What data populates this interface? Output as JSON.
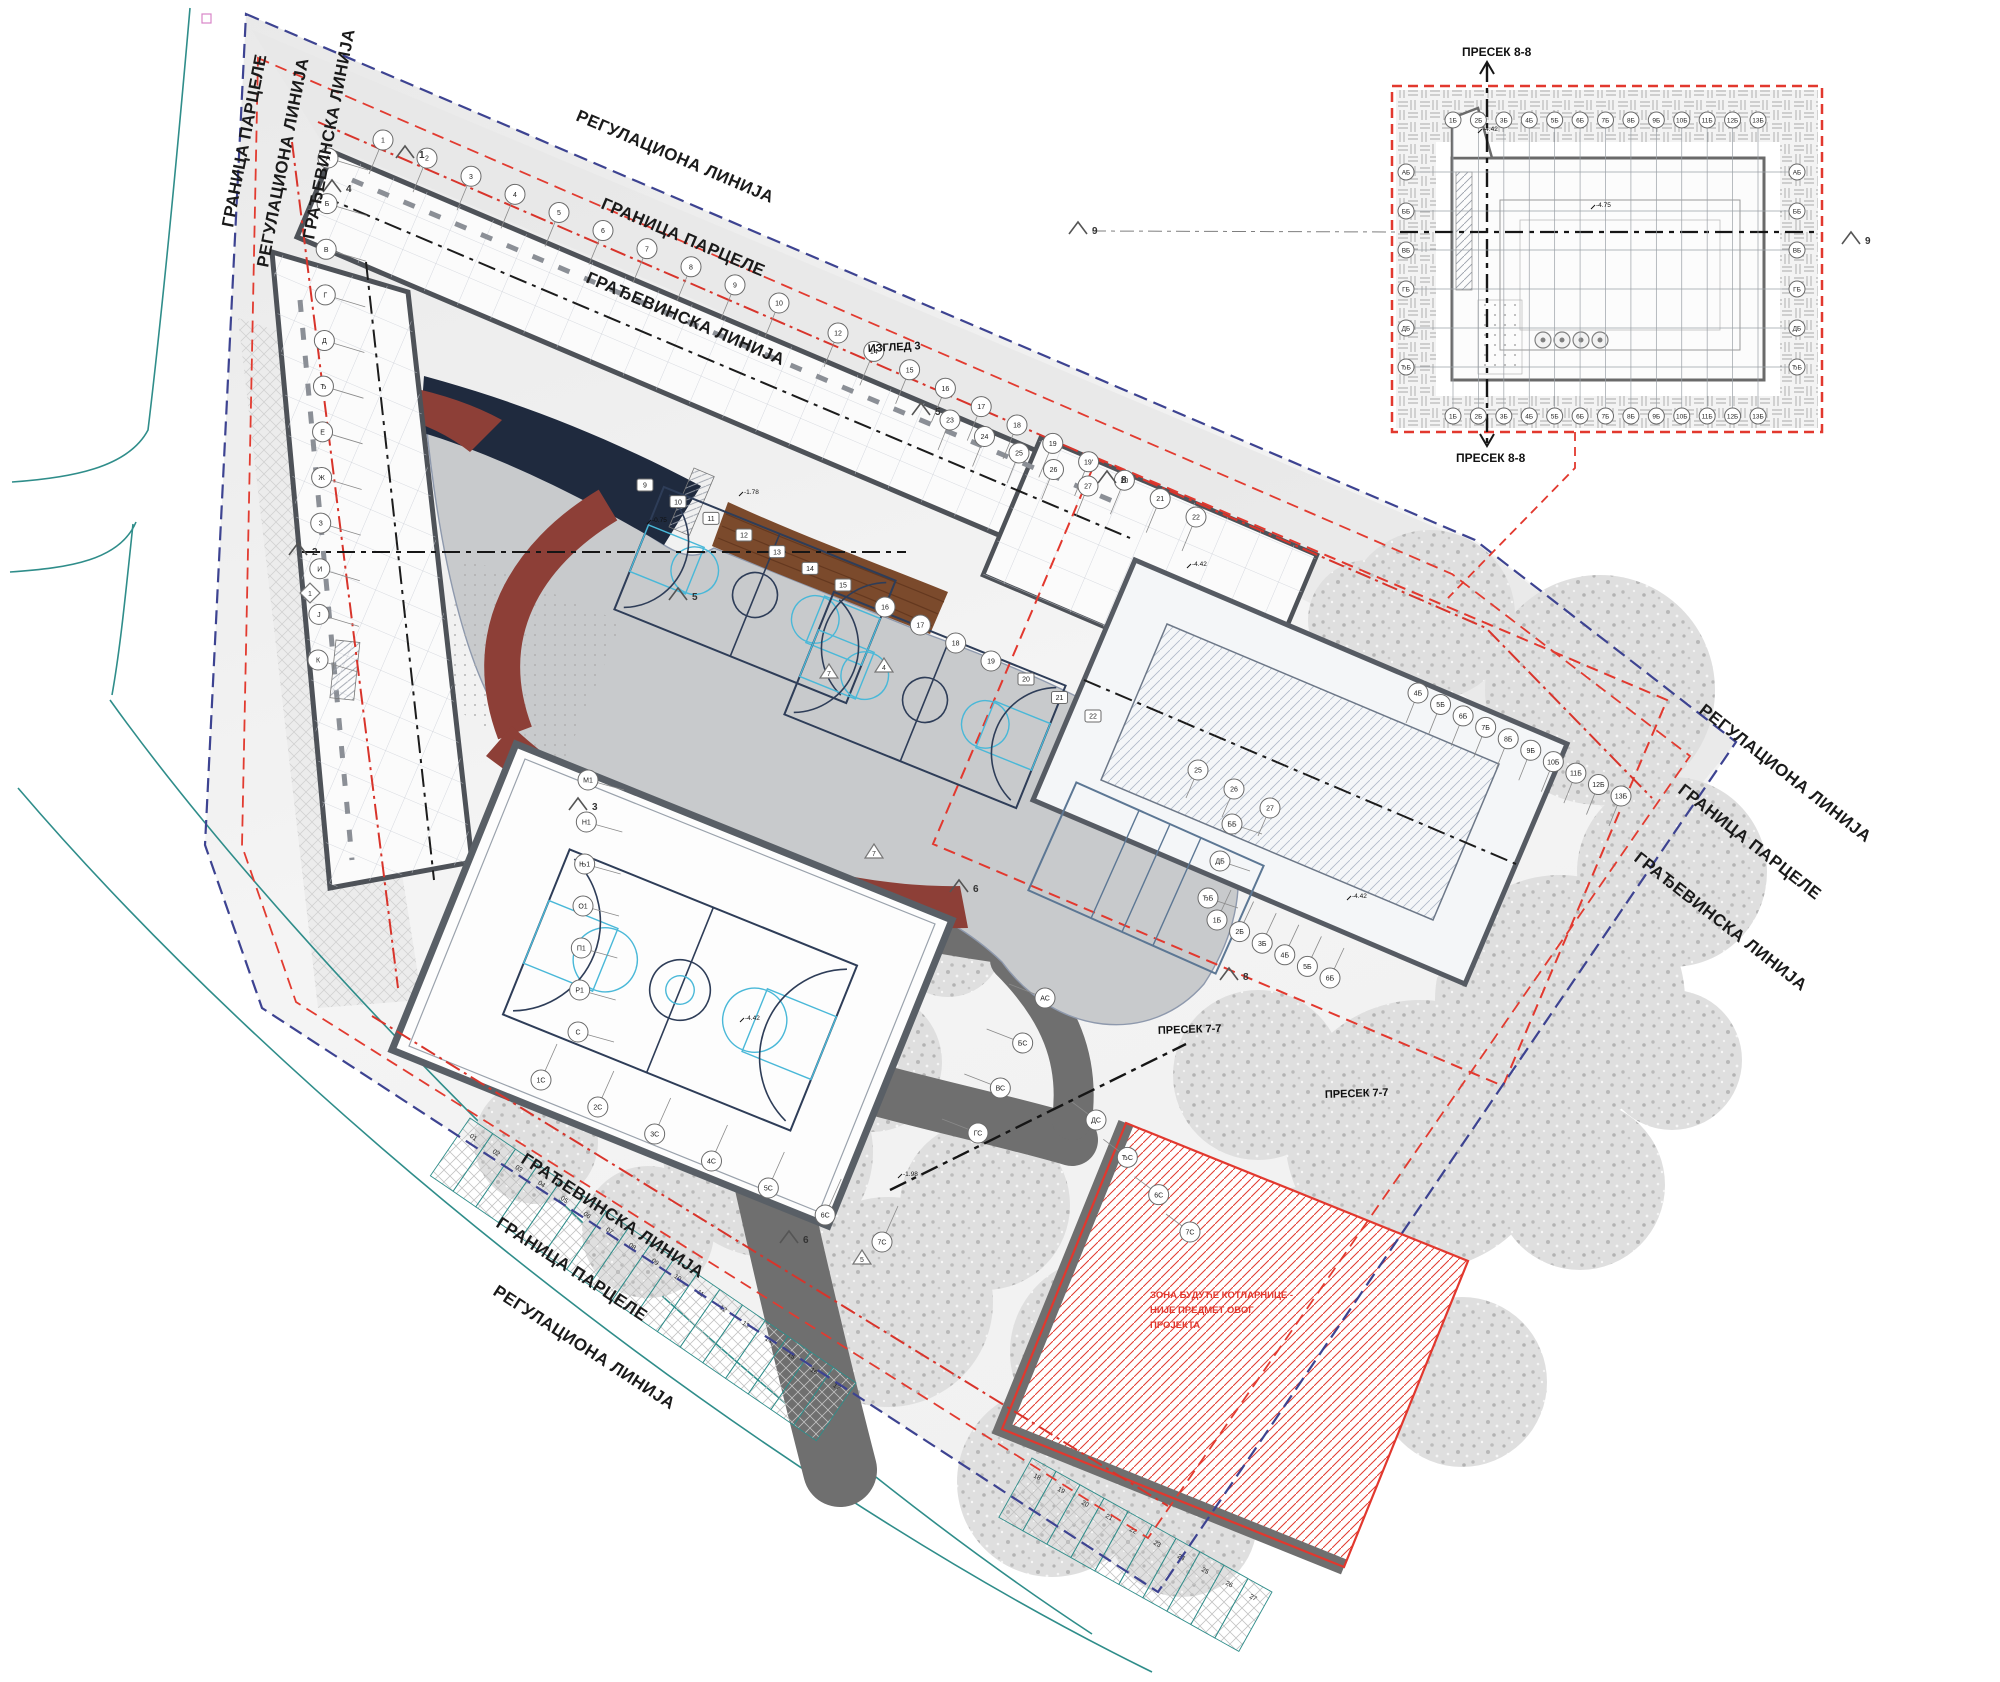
{
  "drawing": {
    "type": "architectural-site-plan",
    "colors": {
      "regulation_line": "#3d4391",
      "parcel_line": "#e23b30",
      "building_line": "#d8342b",
      "street_curb": "#2f8d8a",
      "plaza": "#c8cacc",
      "canopy_navy": "#1f2a3e",
      "canopy_maroon": "#8d3f37",
      "deck_brown": "#7b4a2c",
      "road_gray": "#6f6f6f",
      "tree_gray": "#bcbcbc",
      "court_line": "#2e3d58",
      "court_accent": "#49b8d8",
      "zone_red": "#e2382e"
    },
    "boundary_labels": [
      {
        "text": "РЕГУЛАЦИОНА ЛИНИЈА",
        "x": 575,
        "y": 120,
        "rot": 23
      },
      {
        "text": "ГРАНИЦА ПАРЦЕЛЕ",
        "x": 600,
        "y": 208,
        "rot": 23
      },
      {
        "text": "ГРАЂЕВИНСКА ЛИНИЈА",
        "x": 585,
        "y": 282,
        "rot": 23
      },
      {
        "text": "ГРАНИЦА ПАРЦЕЛЕ",
        "x": 233,
        "y": 228,
        "rot": -79
      },
      {
        "text": "РЕГУЛАЦИОНА ЛИНИЈА",
        "x": 268,
        "y": 268,
        "rot": -79
      },
      {
        "text": "ГРАЂЕВИНСКА ЛИНИЈА",
        "x": 314,
        "y": 240,
        "rot": -79
      },
      {
        "text": "РЕГУЛАЦИОНА ЛИНИЈА",
        "x": 1698,
        "y": 712,
        "rot": 38
      },
      {
        "text": "ГРАНИЦА ПАРЦЕЛЕ",
        "x": 1677,
        "y": 792,
        "rot": 38
      },
      {
        "text": "ГРАЂЕВИНСКА ЛИНИЈА",
        "x": 1633,
        "y": 860,
        "rot": 38
      },
      {
        "text": "ГРАЂЕВИНСКА ЛИНИЈА",
        "x": 520,
        "y": 1162,
        "rot": 33
      },
      {
        "text": "ГРАНИЦА ПАРЦЕЛЕ",
        "x": 495,
        "y": 1226,
        "rot": 33
      },
      {
        "text": "РЕГУЛАЦИОНА ЛИНИЈА",
        "x": 492,
        "y": 1294,
        "rot": 33
      }
    ],
    "section_labels": [
      {
        "text": "ПРЕСЕК 7-7",
        "x": 1158,
        "y": 1034,
        "rot": -2
      },
      {
        "text": "ПРЕСЕК 7-7",
        "x": 1325,
        "y": 1098,
        "rot": -2
      },
      {
        "text": "ИЗГЛЕД 3",
        "x": 868,
        "y": 352,
        "rot": -3
      }
    ],
    "inset": {
      "title_top": "ПРЕСЕК 8-8",
      "title_bottom": "ПРЕСЕК 8-8",
      "section_marker": "9"
    },
    "zone_note": {
      "lines": [
        "ЗОНА БУДУЋЕ КОТЛАРНИЦЕ -",
        "НИЈЕ ПРЕДМЕТ ОВОГ",
        "ПРОЈЕКТА"
      ],
      "x": 1150,
      "y": 1298,
      "color": "#e2382e"
    },
    "section_markers": [
      {
        "label": "1",
        "x": 405,
        "y": 152,
        "shape": "chevron"
      },
      {
        "label": "4",
        "x": 332,
        "y": 186,
        "shape": "chevron"
      },
      {
        "label": "2",
        "x": 298,
        "y": 549,
        "shape": "chevron"
      },
      {
        "label": "1",
        "x": 310,
        "y": 593,
        "shape": "diamond"
      },
      {
        "label": "3",
        "x": 578,
        "y": 804,
        "shape": "chevron"
      },
      {
        "label": "5",
        "x": 678,
        "y": 594,
        "shape": "chevron"
      },
      {
        "label": "5",
        "x": 921,
        "y": 409,
        "shape": "chevron"
      },
      {
        "label": "4",
        "x": 884,
        "y": 666,
        "shape": "triangle"
      },
      {
        "label": "7",
        "x": 829,
        "y": 672,
        "shape": "triangle"
      },
      {
        "label": "7",
        "x": 874,
        "y": 852,
        "shape": "triangle"
      },
      {
        "label": "6",
        "x": 789,
        "y": 1237,
        "shape": "chevron"
      },
      {
        "label": "5",
        "x": 862,
        "y": 1258,
        "shape": "triangle"
      },
      {
        "label": "6",
        "x": 959,
        "y": 886,
        "shape": "chevron"
      },
      {
        "label": "8",
        "x": 1107,
        "y": 477,
        "shape": "chevron"
      },
      {
        "label": "8",
        "x": 1229,
        "y": 974,
        "shape": "chevron"
      },
      {
        "label": "9",
        "x": 1078,
        "y": 228,
        "shape": "chevron"
      },
      {
        "label": "9",
        "x": 1851,
        "y": 238,
        "shape": "chevron"
      }
    ],
    "grid_runs": [
      {
        "labels": [
          "1",
          "2",
          "3",
          "4",
          "5",
          "6",
          "7",
          "8",
          "9",
          "10"
        ],
        "x1": 383,
        "y1": 140,
        "x2": 779,
        "y2": 303,
        "stub": [
          -14,
          34
        ]
      },
      {
        "labels": [
          "12",
          "14",
          "15",
          "16",
          "17",
          "18",
          "19",
          "19'",
          "20",
          "21",
          "22"
        ],
        "x1": 838,
        "y1": 333,
        "x2": 1196,
        "y2": 517,
        "stub": [
          -14,
          34
        ]
      },
      {
        "labels": [
          "23",
          "24",
          "25",
          "26",
          "27"
        ],
        "x1": 950,
        "y1": 420,
        "x2": 1088,
        "y2": 486,
        "stub": [
          -12,
          30
        ]
      },
      {
        "labels": [
          "25",
          "26",
          "27"
        ],
        "x1": 1198,
        "y1": 770,
        "x2": 1270,
        "y2": 808,
        "stub": [
          -12,
          28
        ]
      },
      {
        "labels": [
          "А",
          "Б",
          "В",
          "Г",
          "Д",
          "Ђ",
          "Е",
          "Ж",
          "З",
          "И",
          "Ј",
          "К"
        ],
        "x1": 328,
        "y1": 158,
        "x2": 318,
        "y2": 660,
        "stub": [
          40,
          12
        ]
      },
      {
        "labels": [
          "М1",
          "Н1",
          "Њ1",
          "О1",
          "П1",
          "Р1",
          "С"
        ],
        "x1": 588,
        "y1": 780,
        "x2": 578,
        "y2": 1032,
        "stub": [
          36,
          10
        ]
      },
      {
        "labels": [
          "1С",
          "2С",
          "3С",
          "4С",
          "5С",
          "6С",
          "7С"
        ],
        "x1": 541,
        "y1": 1080,
        "x2": 882,
        "y2": 1242,
        "stub": [
          16,
          -36
        ]
      },
      {
        "labels": [
          "АС",
          "БС",
          "ВС",
          "ГС"
        ],
        "x1": 1045,
        "y1": 998,
        "x2": 978,
        "y2": 1133,
        "stub": [
          -36,
          -14
        ]
      },
      {
        "labels": [
          "ДС",
          "ЂС",
          "6С",
          "7С"
        ],
        "x1": 1096,
        "y1": 1120,
        "x2": 1190,
        "y2": 1232,
        "stub": [
          -24,
          -18
        ]
      },
      {
        "labels": [
          "4Б",
          "5Б",
          "6Б",
          "7Б",
          "8Б",
          "9Б",
          "10Б",
          "11Б",
          "12Б",
          "13Б"
        ],
        "x1": 1418,
        "y1": 693,
        "x2": 1621,
        "y2": 796,
        "stub": [
          -12,
          30
        ]
      },
      {
        "labels": [
          "1Б",
          "2Б",
          "3Б",
          "4Б",
          "5Б",
          "6Б"
        ],
        "x1": 1217,
        "y1": 920,
        "x2": 1330,
        "y2": 978,
        "stub": [
          14,
          -30
        ]
      },
      {
        "labels": [
          "ЂБ",
          "ДБ",
          "ББ"
        ],
        "x1": 1208,
        "y1": 898,
        "x2": 1232,
        "y2": 824,
        "stub": [
          30,
          10
        ]
      },
      {
        "labels": [
          "9",
          "10",
          "11",
          "12",
          "13",
          "14",
          "15"
        ],
        "x1": 645,
        "y1": 485,
        "x2": 843,
        "y2": 585,
        "shape": "square"
      },
      {
        "labels": [
          "16",
          "17",
          "18",
          "19"
        ],
        "x1": 885,
        "y1": 607,
        "x2": 991,
        "y2": 661
      },
      {
        "labels": [
          "20",
          "21",
          "22"
        ],
        "x1": 1026,
        "y1": 679,
        "x2": 1093,
        "y2": 716,
        "shape": "square"
      },
      {
        "labels": [
          "1Б",
          "2Б",
          "3Б",
          "4Б",
          "5Б",
          "6Б",
          "7Б",
          "8Б",
          "9Б",
          "10Б",
          "11Б",
          "12Б",
          "13Б"
        ],
        "x1": 1453,
        "y1": 120,
        "x2": 1758,
        "y2": 120,
        "r": 8,
        "rail": [
          0,
          7,
          0,
          292
        ]
      },
      {
        "labels": [
          "1Б",
          "2Б",
          "3Б",
          "4Б",
          "5Б",
          "6Б",
          "7Б",
          "8Б",
          "9Б",
          "10Б",
          "11Б",
          "12Б",
          "13Б"
        ],
        "x1": 1453,
        "y1": 416,
        "x2": 1758,
        "y2": 416,
        "r": 8
      },
      {
        "labels": [
          "АБ",
          "ББ",
          "ВБ",
          "ГБ",
          "ДБ",
          "ЂБ"
        ],
        "x1": 1406,
        "y1": 172,
        "x2": 1406,
        "y2": 367,
        "r": 8,
        "rail": [
          7,
          0,
          386,
          0
        ]
      },
      {
        "labels": [
          "АБ",
          "ББ",
          "ВБ",
          "ГБ",
          "ДБ",
          "ЂБ"
        ],
        "x1": 1797,
        "y1": 172,
        "x2": 1797,
        "y2": 367,
        "r": 8
      }
    ],
    "parking": [
      {
        "labels": [
          "01",
          "02",
          "03",
          "04",
          "05",
          "06",
          "07",
          "08",
          "09",
          "10",
          "11",
          "12",
          "13",
          "14",
          "15",
          "16",
          "17"
        ],
        "x1": 470,
        "y1": 1118,
        "x2": 856,
        "y2": 1383,
        "depth": 70
      },
      {
        "labels": [
          "18",
          "19",
          "20",
          "21",
          "22",
          "23",
          "24",
          "25",
          "26",
          "27"
        ],
        "x1": 1032,
        "y1": 1458,
        "x2": 1272,
        "y2": 1592,
        "depth": 68
      }
    ],
    "courts": [
      {
        "cx": 755,
        "cy": 595,
        "w": 250,
        "h": 132,
        "rot": 22,
        "type": "basketball"
      },
      {
        "cx": 925,
        "cy": 700,
        "w": 250,
        "h": 132,
        "rot": 22,
        "type": "basketball"
      },
      {
        "cx": 1146,
        "cy": 878,
        "w": 205,
        "h": 118,
        "rot": 24,
        "type": "volleyball"
      },
      {
        "cx": 680,
        "cy": 990,
        "w": 310,
        "h": 178,
        "rot": 22,
        "type": "basketball-indoor"
      }
    ],
    "trees": [
      [
        1430,
        615,
        85
      ],
      [
        1600,
        690,
        115
      ],
      [
        1672,
        872,
        95
      ],
      [
        1560,
        1000,
        125
      ],
      [
        1420,
        1135,
        135
      ],
      [
        1258,
        1075,
        85
      ],
      [
        1580,
        1185,
        85
      ],
      [
        1305,
        1302,
        115
      ],
      [
        1105,
        1352,
        95
      ],
      [
        1462,
        1382,
        85
      ],
      [
        985,
        1205,
        85
      ],
      [
        768,
        1152,
        105
      ],
      [
        888,
        1302,
        105
      ],
      [
        1052,
        1482,
        95
      ],
      [
        872,
        1062,
        70
      ],
      [
        648,
        1062,
        62
      ],
      [
        536,
        1142,
        62
      ],
      [
        648,
        1232,
        66
      ],
      [
        1182,
        1522,
        75
      ],
      [
        948,
        942,
        55
      ],
      [
        1368,
        620,
        60
      ],
      [
        1672,
        1060,
        70
      ]
    ],
    "spot_elevations": [
      {
        "t": "-1.78",
        "x": 744,
        "y": 494
      },
      {
        "t": "-0.75",
        "x": 652,
        "y": 522
      },
      {
        "t": "-4.42",
        "x": 1192,
        "y": 566
      },
      {
        "t": "-4.42",
        "x": 1483,
        "y": 131
      },
      {
        "t": "-4.75",
        "x": 1596,
        "y": 207
      },
      {
        "t": "-4.42",
        "x": 1352,
        "y": 898
      },
      {
        "t": "-1.98",
        "x": 903,
        "y": 1176
      },
      {
        "t": "-4.42",
        "x": 745,
        "y": 1020
      }
    ]
  }
}
